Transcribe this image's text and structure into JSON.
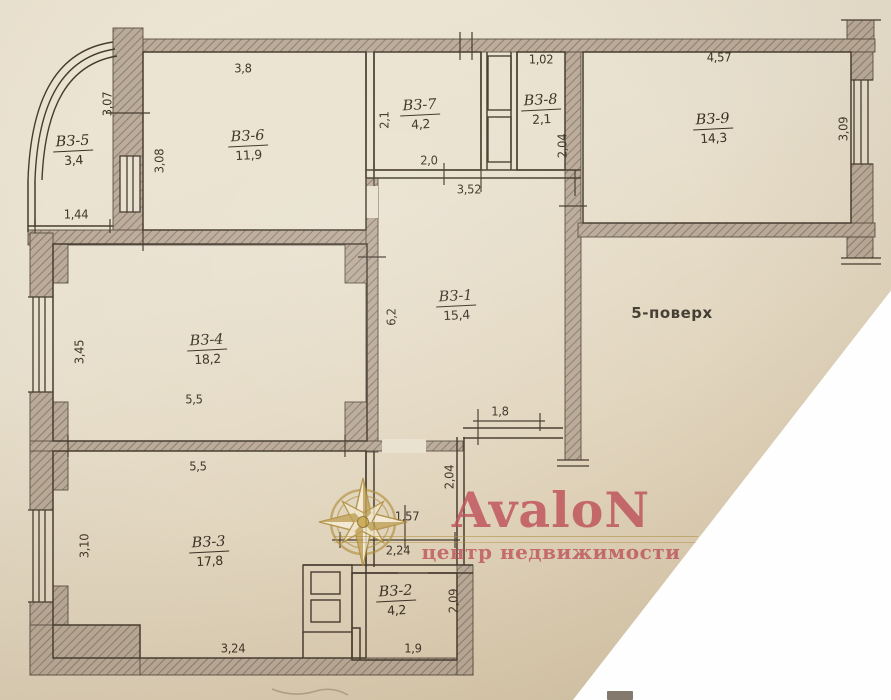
{
  "plan": {
    "floor_note": "5-поверх",
    "rooms": [
      {
        "name": "ВЗ-5",
        "area": "3,4",
        "x": 73,
        "y": 149
      },
      {
        "name": "ВЗ-6",
        "area": "11,9",
        "x": 248,
        "y": 144
      },
      {
        "name": "ВЗ-7",
        "area": "4,2",
        "x": 420,
        "y": 113
      },
      {
        "name": "ВЗ-8",
        "area": "2,1",
        "x": 541,
        "y": 108
      },
      {
        "name": "ВЗ-9",
        "area": "14,3",
        "x": 713,
        "y": 127
      },
      {
        "name": "ВЗ-1",
        "area": "15,4",
        "x": 456,
        "y": 304
      },
      {
        "name": "ВЗ-4",
        "area": "18,2",
        "x": 207,
        "y": 348
      },
      {
        "name": "ВЗ-3",
        "area": "17,8",
        "x": 209,
        "y": 550
      },
      {
        "name": "ВЗ-2",
        "area": "4,2",
        "x": 396,
        "y": 599
      }
    ],
    "dimensions": [
      {
        "text": "3,8",
        "x": 243,
        "y": 68,
        "rot": 0
      },
      {
        "text": "3,07",
        "x": 107,
        "y": 104,
        "rot": -90
      },
      {
        "text": "3,08",
        "x": 159,
        "y": 161,
        "rot": -90
      },
      {
        "text": "1,44",
        "x": 76,
        "y": 214,
        "rot": 0
      },
      {
        "text": "2,1",
        "x": 384,
        "y": 120,
        "rot": -90
      },
      {
        "text": "2,0",
        "x": 429,
        "y": 160,
        "rot": 0
      },
      {
        "text": "3,52",
        "x": 469,
        "y": 189,
        "rot": 0
      },
      {
        "text": "1,02",
        "x": 541,
        "y": 59,
        "rot": 0
      },
      {
        "text": "2,04",
        "x": 562,
        "y": 146,
        "rot": -90
      },
      {
        "text": "4,57",
        "x": 719,
        "y": 57,
        "rot": 0
      },
      {
        "text": "3,09",
        "x": 843,
        "y": 129,
        "rot": -90
      },
      {
        "text": "6,2",
        "x": 391,
        "y": 317,
        "rot": -90
      },
      {
        "text": "3,45",
        "x": 79,
        "y": 352,
        "rot": -90
      },
      {
        "text": "5,5",
        "x": 194,
        "y": 399,
        "rot": 0
      },
      {
        "text": "5,5",
        "x": 198,
        "y": 466,
        "rot": 0
      },
      {
        "text": "1,8",
        "x": 500,
        "y": 411,
        "rot": 0
      },
      {
        "text": "2,04",
        "x": 449,
        "y": 477,
        "rot": -90
      },
      {
        "text": "1,57",
        "x": 407,
        "y": 516,
        "rot": 0
      },
      {
        "text": "2,24",
        "x": 398,
        "y": 550,
        "rot": 0
      },
      {
        "text": "3,10",
        "x": 84,
        "y": 546,
        "rot": -90
      },
      {
        "text": "2,09",
        "x": 453,
        "y": 601,
        "rot": -90
      },
      {
        "text": "1,9",
        "x": 413,
        "y": 648,
        "rot": 0
      },
      {
        "text": "3,24",
        "x": 233,
        "y": 648,
        "rot": 0
      }
    ]
  },
  "watermark": {
    "brand": "AvaloN",
    "tagline": "центр недвижимости",
    "logo": "compass-star",
    "brand_color": "#be505a",
    "gold_color": "#b08e3c"
  },
  "colors": {
    "paper_top": "#ece4d2",
    "paper_bottom": "#d2c1a4",
    "line": "#463c2f",
    "wall_fill": "#b3a392",
    "torn_corner": "#fefefe"
  }
}
